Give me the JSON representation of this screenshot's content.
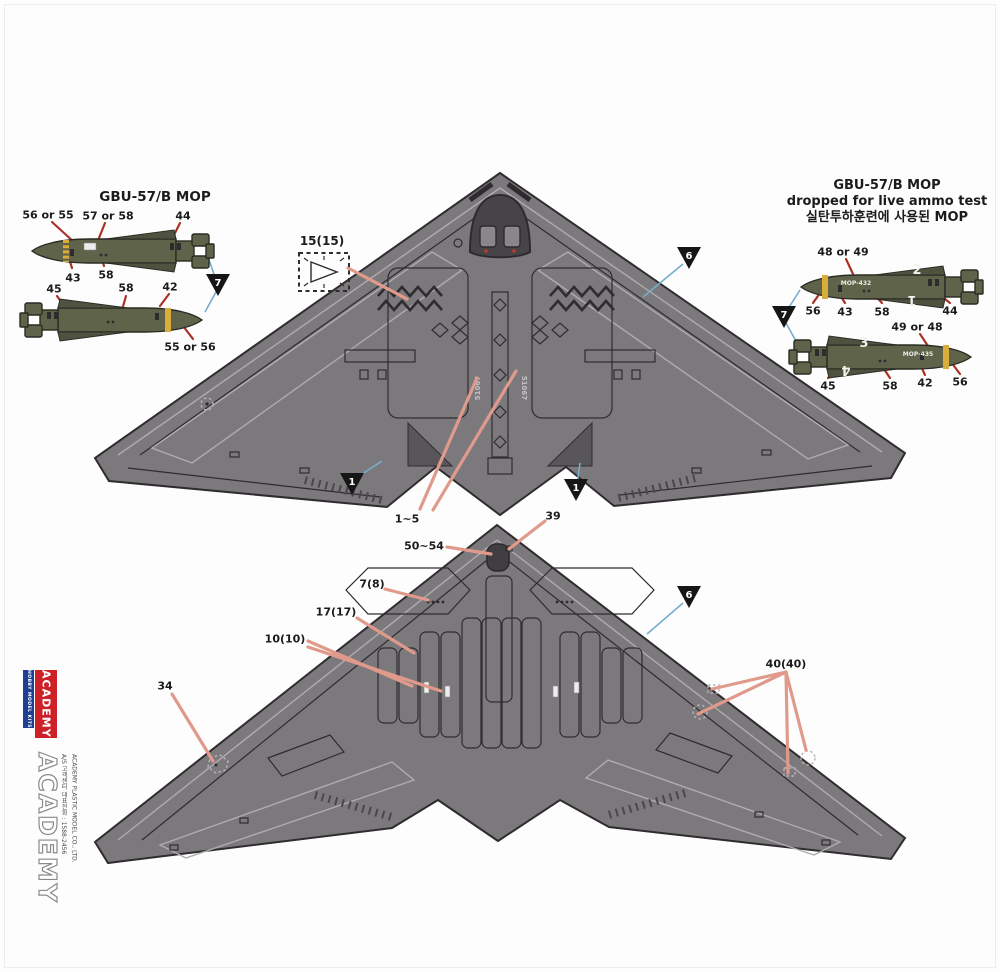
{
  "left_panel": {
    "title": "GBU-57/B MOP",
    "marker": "7",
    "callouts": {
      "c1": "56 or 55",
      "c2": "57 or 58",
      "c3": "44",
      "c4": "43",
      "c5": "58",
      "c6": "45",
      "c7": "58",
      "c8": "42",
      "c9": "55 or 56"
    }
  },
  "right_panel": {
    "title1": "GBU-57/B MOP",
    "title2": "dropped for live ammo test",
    "title3": "실탄투하훈련에 사용된 MOP",
    "marker": "7",
    "callouts": {
      "c1": "48 or 49",
      "c2": "56",
      "c3": "43",
      "c4": "58",
      "c5": "44",
      "c6": "49 or 48",
      "c7": "45",
      "c8": "58",
      "c9": "42",
      "c10": "56"
    },
    "bomb_top": {
      "decal": "MOP-432",
      "num_top": "2",
      "num_bottom": "1"
    },
    "bomb_bottom": {
      "decal": "MOP-435",
      "num_top": "3",
      "num_bottom": "4"
    }
  },
  "top_view": {
    "serial": "51067",
    "labels": {
      "decal15": "15(15)",
      "range": "1~5"
    },
    "markers": {
      "m6": "6",
      "m1l": "1",
      "m1r": "1"
    }
  },
  "bottom_view": {
    "labels": {
      "l39": "39",
      "l50": "50~54",
      "l7": "7(8)",
      "l17": "17(17)",
      "l10": "10(10)",
      "l34": "34",
      "l40": "40(40)"
    },
    "markers": {
      "m6": "6"
    }
  },
  "sidebar": {
    "logo_text": "ACADEMY",
    "logo_sub": "HOBBY MODEL KITS",
    "brand": "ACADEMY",
    "company": "ACADEMY PLASTIC MODEL CO., LTD.",
    "service": "A/S 고객센터 대표전화 : 1588-2456"
  }
}
